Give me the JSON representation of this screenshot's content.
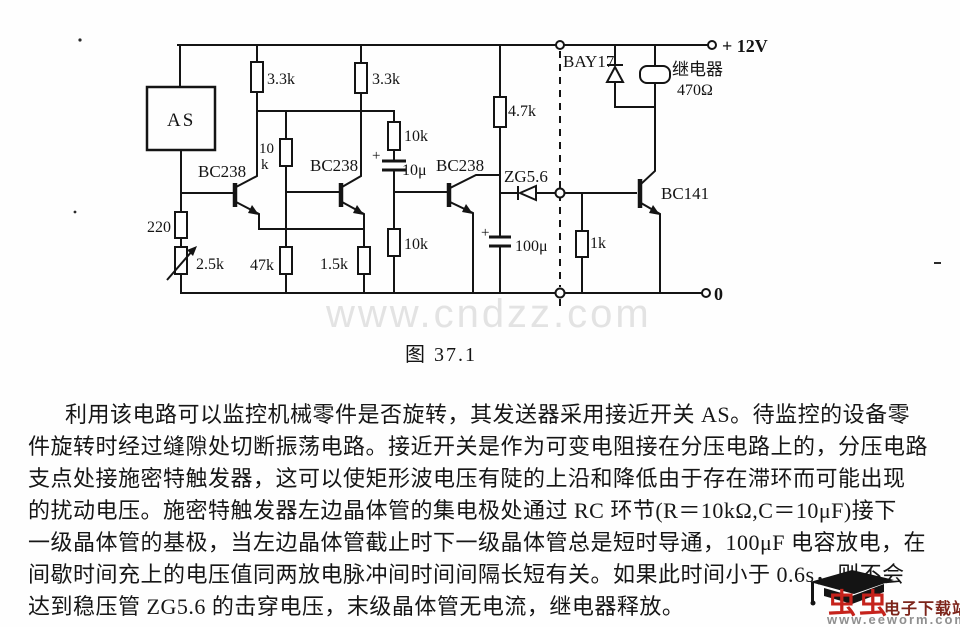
{
  "watermark": "www.cndzz.com",
  "caption": "图 37.1",
  "colors": {
    "ink": "#141414",
    "watermark_gray": "#e3e3e3",
    "logo_red": "#c5221b",
    "logo_dark_red": "#7c241a",
    "logo_gray": "#8f8f8f"
  },
  "circuit": {
    "power_label": "+ 12V",
    "ground_label": "0",
    "as_label": "AS",
    "labels": {
      "r1": "3.3k",
      "r2": "3.3k",
      "r3_line1": "10",
      "r3_line2": "k",
      "r4": "10k",
      "r5": "4.7k",
      "r6": "220",
      "r7": "2.5k",
      "r8": "47k",
      "r9": "1.5k",
      "r10": "10k",
      "r11": "1k",
      "c1_plus": "+",
      "c1": "10μ",
      "c2_plus": "+",
      "c2": "100μ",
      "q1": "BC238",
      "q2": "BC238",
      "q3": "BC238",
      "q4": "BC141",
      "d1": "BAY17",
      "dz": "ZG5.6",
      "relay_name": "继电器",
      "relay_value": "470Ω"
    }
  },
  "paragraph": {
    "lines": [
      "利用该电路可以监控机械零件是否旋转，其发送器采用接近开关 AS。待监控的设备零",
      "件旋转时经过缝隙处切断振荡电路。接近开关是作为可变电阻接在分压电路上的，分压电路",
      "支点处接施密特触发器，这可以使矩形波电压有陡的上沿和降低由于存在滞环而可能出现",
      "的扰动电压。施密特触发器左边晶体管的集电极处通过 RC 环节(R＝10kΩ,C＝10μF)接下",
      "一级晶体管的基极，当左边晶体管截止时下一级晶体管总是短时导通，100μF 电容放电，在",
      "间歇时间充上的电压值同两放电脉冲间时间间隔长短有关。如果此时间小于 0.6s，则不会",
      "达到稳压管 ZG5.6 的击穿电压，末级晶体管无电流，继电器释放。"
    ]
  },
  "logo": {
    "brand": "虫虫",
    "site_name": "电子下载站",
    "url": "www.eeworm.com"
  }
}
